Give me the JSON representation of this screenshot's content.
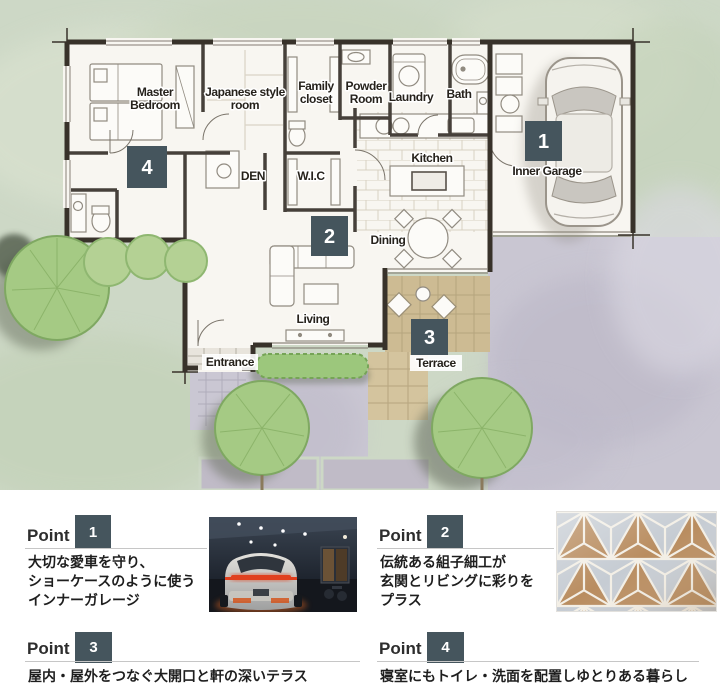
{
  "palette": {
    "badge": "#45555d",
    "lawn": "#cdd8c6",
    "driveway": "#c9c6d2",
    "terrace": "#cdbb93",
    "wall": "#38322a",
    "floor": "#f8f6f1",
    "tree": "#a5ca84",
    "divider": "#c6c6c6",
    "tail_light": "#e0401f",
    "kumiko_wood": "#b98d60"
  },
  "plan": {
    "labels": {
      "master_1": "Master",
      "master_2": "Bedroom",
      "japanese_1": "Japanese style",
      "japanese_2": "room",
      "family_1": "Family",
      "family_2": "closet",
      "powder_1": "Powder",
      "powder_2": "Room",
      "laundry": "Laundry",
      "bath": "Bath",
      "kitchen": "Kitchen",
      "den": "DEN",
      "wic": "W.I.C",
      "dining": "Dining",
      "living": "Living",
      "entrance": "Entrance",
      "terrace": "Terrace",
      "garage": "Inner Garage"
    },
    "badges": {
      "garage": "1",
      "living": "2",
      "terrace": "3",
      "bedroom": "4"
    }
  },
  "points": [
    {
      "label": "Point",
      "num": "1",
      "lines": [
        "大切な愛車を守り、",
        "ショーケースのように使う",
        "インナーガレージ"
      ],
      "image": "inner-garage-night-photo"
    },
    {
      "label": "Point",
      "num": "2",
      "lines": [
        "伝統ある組子細工が",
        "玄関とリビングに彩りを",
        "プラス"
      ],
      "image": "kumiko-woodwork-photo"
    },
    {
      "label": "Point",
      "num": "3",
      "lines": [
        "屋内・屋外をつなぐ大開口と軒の深いテラス"
      ]
    },
    {
      "label": "Point",
      "num": "4",
      "lines": [
        "寝室にもトイレ・洗面を配置しゆとりある暮らし"
      ]
    }
  ]
}
